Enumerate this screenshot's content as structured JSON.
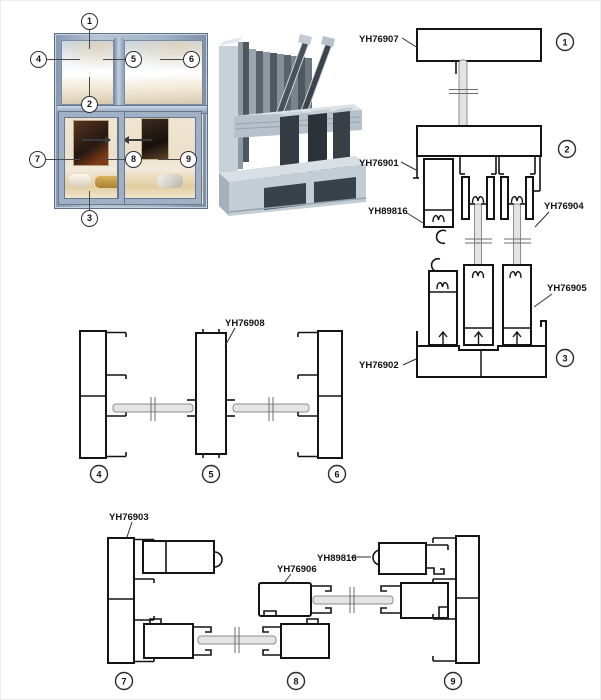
{
  "figure_title": "Aluminium sliding window profile system diagram",
  "window": {
    "callouts": [
      "1",
      "2",
      "3",
      "4",
      "5",
      "6",
      "7",
      "8",
      "9"
    ]
  },
  "sections": {
    "vertical": {
      "markers": [
        "1",
        "2",
        "3"
      ],
      "labels": {
        "head_profile": "YH76907",
        "track_profile": "YH76901",
        "hook_profile": "YH89816",
        "sash_profile": "YH76904",
        "sash_bottom_profile": "YH76905",
        "sill_profile": "YH76902"
      }
    },
    "horizontal_top": {
      "markers": [
        "4",
        "5",
        "6"
      ],
      "labels": {
        "mullion_profile": "YH76908"
      }
    },
    "horizontal_bottom": {
      "markers": [
        "7",
        "8",
        "9"
      ],
      "labels": {
        "jamb_profile": "YH76903",
        "interlock_profile": "YH76906",
        "hook_profile": "YH89816"
      }
    }
  },
  "colors": {
    "frame_blue": "#9fb1c7",
    "line_black": "#141414",
    "glass_gray": "#e4e4e4",
    "aluminum_light": "#ccd5dc",
    "aluminum_dark": "#39414a"
  }
}
